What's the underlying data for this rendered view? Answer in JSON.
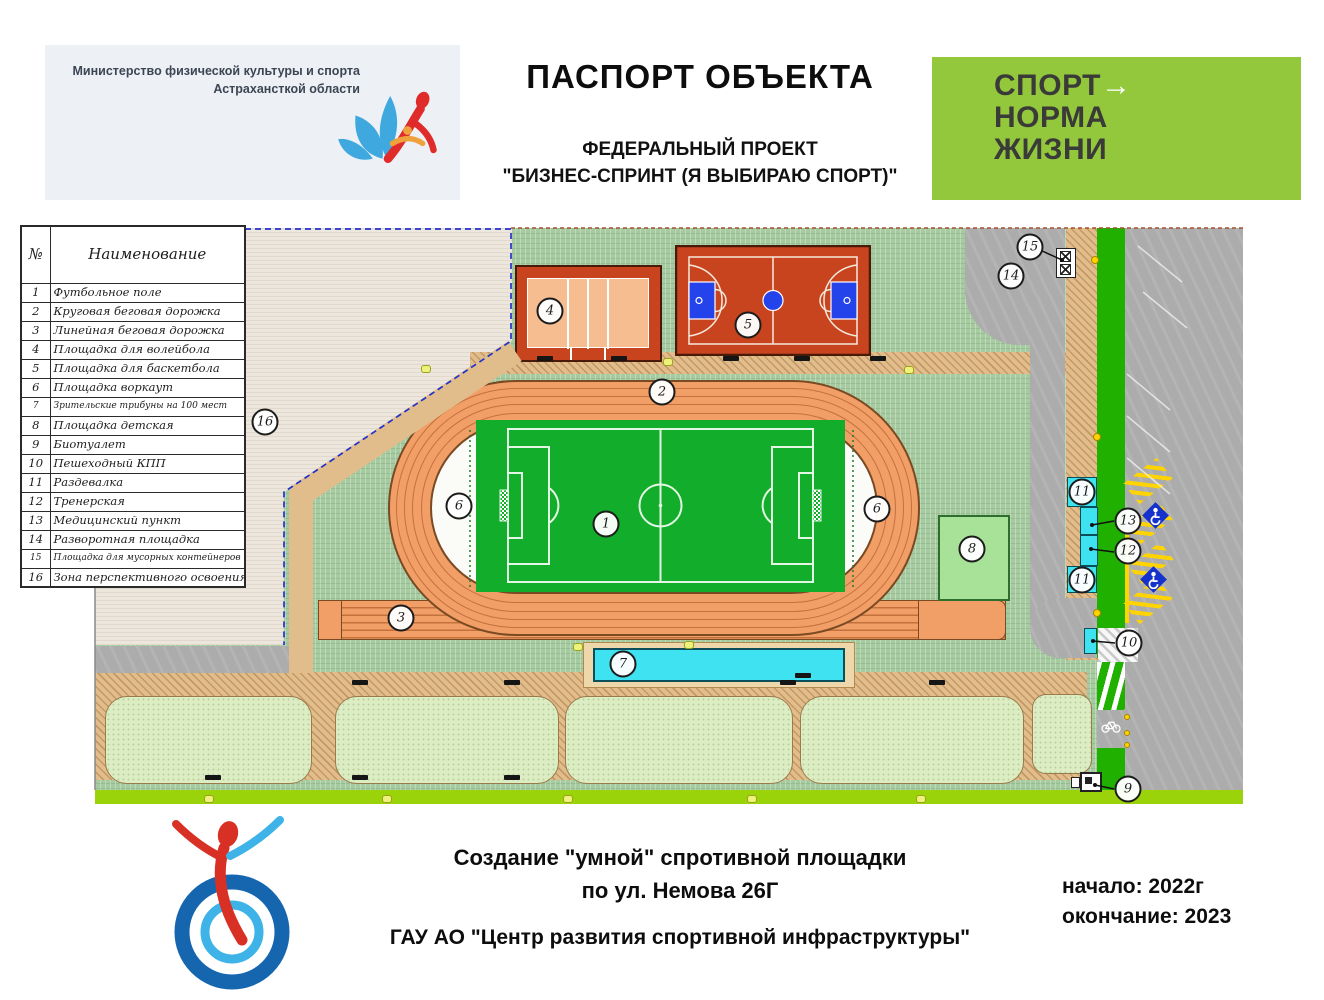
{
  "header": {
    "ministry": {
      "line1": "Министерство физической культуры и спорта",
      "line2": "Астрахансткой области"
    },
    "title": "ПАСПОРТ ОБЪЕКТА",
    "subtitle1": "ФЕДЕРАЛЬНЫЙ ПРОЕКТ",
    "subtitle2": "\"БИЗНЕС-СПРИНТ (Я ВЫБИРАЮ СПОРТ)\"",
    "banner": {
      "line1": "СПОРТ",
      "arrow": "→",
      "line2": "НОРМА",
      "line3": "ЖИЗНИ"
    }
  },
  "legend": {
    "col_num": "№",
    "col_name": "Наименование",
    "rows": [
      {
        "num": "1",
        "label": "Футбольное поле"
      },
      {
        "num": "2",
        "label": "Круговая беговая дорожка"
      },
      {
        "num": "3",
        "label": "Линейная беговая дорожка"
      },
      {
        "num": "4",
        "label": "Площадка для волейбола"
      },
      {
        "num": "5",
        "label": "Площадка для баскетбола"
      },
      {
        "num": "6",
        "label": "Площадка воркаут"
      },
      {
        "num": "7",
        "label": "Зрительские трибуны на 100 мест"
      },
      {
        "num": "8",
        "label": "Площадка детская"
      },
      {
        "num": "9",
        "label": "Биотуалет"
      },
      {
        "num": "10",
        "label": "Пешеходный КПП"
      },
      {
        "num": "11",
        "label": "Раздевалка"
      },
      {
        "num": "12",
        "label": "Тренерская"
      },
      {
        "num": "13",
        "label": "Медицинский пункт"
      },
      {
        "num": "14",
        "label": "Разворотная площадка"
      },
      {
        "num": "15",
        "label": "Площадка для мусорных контейнеров"
      },
      {
        "num": "16",
        "label": "Зона перспективного освоения"
      }
    ]
  },
  "plan": {
    "markers": [
      "1",
      "2",
      "3",
      "4",
      "5",
      "6",
      "6",
      "7",
      "8",
      "9",
      "10",
      "11",
      "11",
      "12",
      "13",
      "14",
      "15",
      "16"
    ]
  },
  "footer": {
    "line1": "Создание \"умной\" спротивной площадки",
    "line2": "по ул. Немова 26Г",
    "org": "ГАУ АО \"Центр развития спортивной инфраструктуры\"",
    "start": "начало: 2022г",
    "end": "окончание: 2023"
  },
  "colors": {
    "banner_green": "#93c83c",
    "site_green": "#a7cba1",
    "track_orange": "#f19e67",
    "field_green": "#12ad2a",
    "court_red": "#c8441f",
    "cyan": "#3ee2f0",
    "road_gray": "#acacac",
    "strip_green": "#1fb000",
    "lime": "#9bd30a",
    "handicap_blue": "#1533cc"
  }
}
